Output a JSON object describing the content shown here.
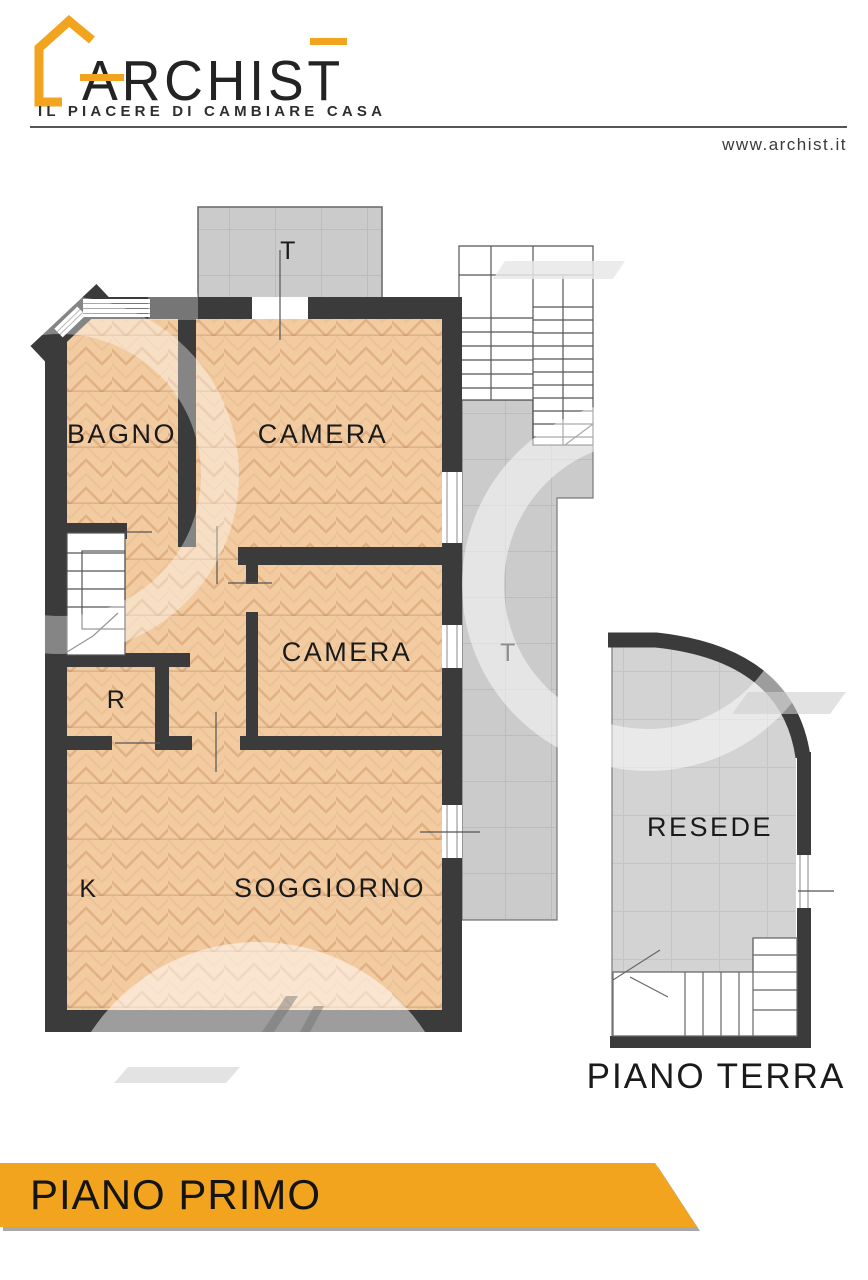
{
  "header": {
    "brand": "ARCHIST",
    "tagline": "IL PIACERE DI CAMBIARE CASA",
    "website": "www.archist.it"
  },
  "colors": {
    "accent_orange": "#F2A41E",
    "wall_dark": "#3B3B3B",
    "parquet_floor": "#F3CBA1",
    "terrace_gray": "#CBCBCB",
    "ground_floor_gray": "#D3D3D3"
  },
  "first_floor": {
    "banner_label": "PIANO PRIMO",
    "room_labels": {
      "terrace_top": "T",
      "bathroom": "BAGNO",
      "bedroom_1": "CAMERA",
      "bedroom_2": "CAMERA",
      "storage": "R",
      "terrace_side": "T",
      "kitchen": "K",
      "living_room": "SOGGIORNO"
    }
  },
  "ground_floor": {
    "caption": "PIANO TERRA",
    "room_labels": {
      "yard": "RESEDE"
    }
  }
}
